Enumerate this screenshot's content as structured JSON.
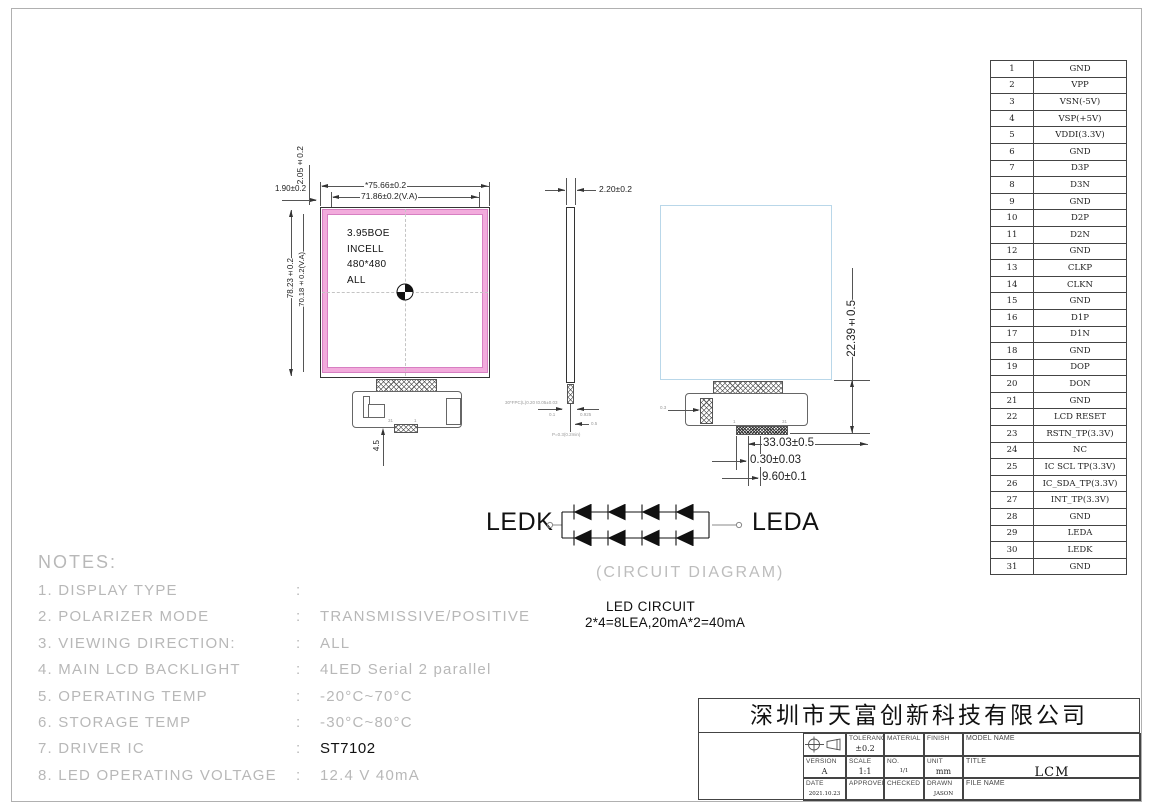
{
  "colors": {
    "va_pink": "#f2abdc",
    "va_pink_edge": "#d77fc2",
    "panel_blue": "#b9d7e9",
    "cad_gray": "#b8b8b8"
  },
  "pin_table": {
    "rows": [
      {
        "no": "1",
        "name": "GND"
      },
      {
        "no": "2",
        "name": "VPP"
      },
      {
        "no": "3",
        "name": "VSN(-5V)"
      },
      {
        "no": "4",
        "name": "VSP(+5V)"
      },
      {
        "no": "5",
        "name": "VDDI(3.3V)"
      },
      {
        "no": "6",
        "name": "GND"
      },
      {
        "no": "7",
        "name": "D3P"
      },
      {
        "no": "8",
        "name": "D3N"
      },
      {
        "no": "9",
        "name": "GND"
      },
      {
        "no": "10",
        "name": "D2P"
      },
      {
        "no": "11",
        "name": "D2N"
      },
      {
        "no": "12",
        "name": "GND"
      },
      {
        "no": "13",
        "name": "CLKP"
      },
      {
        "no": "14",
        "name": "CLKN"
      },
      {
        "no": "15",
        "name": "GND"
      },
      {
        "no": "16",
        "name": "D1P"
      },
      {
        "no": "17",
        "name": "D1N"
      },
      {
        "no": "18",
        "name": "GND"
      },
      {
        "no": "19",
        "name": "DOP"
      },
      {
        "no": "20",
        "name": "DON"
      },
      {
        "no": "21",
        "name": "GND"
      },
      {
        "no": "22",
        "name": "LCD RESET"
      },
      {
        "no": "23",
        "name": "RSTN_TP(3.3V)"
      },
      {
        "no": "24",
        "name": "NC"
      },
      {
        "no": "25",
        "name": "IC SCL TP(3.3V)"
      },
      {
        "no": "26",
        "name": "IC_SDA_TP(3.3V)"
      },
      {
        "no": "27",
        "name": "INT_TP(3.3V)"
      },
      {
        "no": "28",
        "name": "GND"
      },
      {
        "no": "29",
        "name": "LEDA"
      },
      {
        "no": "30",
        "name": "LEDK"
      },
      {
        "no": "31",
        "name": "GND"
      }
    ]
  },
  "front_view": {
    "label_lines": [
      "3.95BOE",
      "INCELL",
      "480*480",
      "ALL"
    ],
    "dims": {
      "outer_w": "*75.66±0.2",
      "va_w": "71.86±0.2(V.A)",
      "outer_h": "78.23±0.2",
      "va_h": "70.18±0.2(V.A)",
      "top_margin": "2.05±0.2",
      "side_margin": "1.90±0.2",
      "fpc_offset": "4.5"
    },
    "pin_marks": {
      "left": "31",
      "right": "1"
    }
  },
  "side_view": {
    "thickness": "2.20±0.2",
    "note": "30*FPC(L)0.20 t0.05±0.03",
    "dim_a": "0.1",
    "dim_b": "0.925",
    "dim_c": "0.5",
    "caption": "P=0.3(0.2min)"
  },
  "back_view": {
    "dims": {
      "fpc_drop": "22.39±0.5",
      "fpc_w": "33.03±0.5",
      "pitch": "0.30±0.03",
      "conn_w": "9.60±0.1",
      "patch": "0.3"
    },
    "pin_marks": {
      "left": "1",
      "right": "31"
    }
  },
  "led_circuit": {
    "cathode": "LEDK",
    "anode": "LEDA",
    "caption": "(CIRCUIT DIAGRAM)",
    "title": "LED CIRCUIT",
    "spec": "2*4=8LEA,20mA*2=40mA"
  },
  "notes": {
    "heading": "NOTES:",
    "items": [
      {
        "num": "1.",
        "label": "DISPLAY TYPE",
        "colon": ":",
        "value": ""
      },
      {
        "num": "2.",
        "label": "POLARIZER MODE",
        "colon": ":",
        "value": "TRANSMISSIVE/POSITIVE"
      },
      {
        "num": "3.",
        "label": "VIEWING DIRECTION:",
        "colon": ":",
        "value": "ALL"
      },
      {
        "num": "4.",
        "label": "MAIN LCD BACKLIGHT",
        "colon": ":",
        "value": "4LED Serial 2 parallel"
      },
      {
        "num": "5.",
        "label": "OPERATING TEMP",
        "colon": ":",
        "value": "-20°C~70°C"
      },
      {
        "num": "6.",
        "label": "STORAGE TEMP",
        "colon": ":",
        "value": "-30°C~80°C"
      },
      {
        "num": "7.",
        "label": "DRIVER IC",
        "colon": ":",
        "value": "ST7102",
        "dark": true
      },
      {
        "num": "8.",
        "label": "LED OPERATING VOLTAGE",
        "colon": ":",
        "value": "12.4 V 40mA"
      }
    ]
  },
  "title_block": {
    "company": "深圳市天富创新科技有限公司",
    "tolerance_label": "TOLERANCE",
    "tolerance": "±0.2",
    "material_label": "MATERIAL",
    "finish_label": "FINISH",
    "model_label": "MODEL NAME",
    "version_label": "VERSION",
    "version": "A",
    "scale_label": "SCALE",
    "scale": "1:1",
    "no_label": "NO.",
    "no": "1/1",
    "unit_label": "UNIT",
    "unit": "mm",
    "title_label": "TITLE",
    "title": "LCM",
    "date_label": "DATE",
    "date": "2021.10.23",
    "approved_label": "APPROVED",
    "checked_label": "CHECKED",
    "drawn_label": "DRAWN",
    "drawn": "JASON",
    "file_label": "FILE NAME"
  }
}
